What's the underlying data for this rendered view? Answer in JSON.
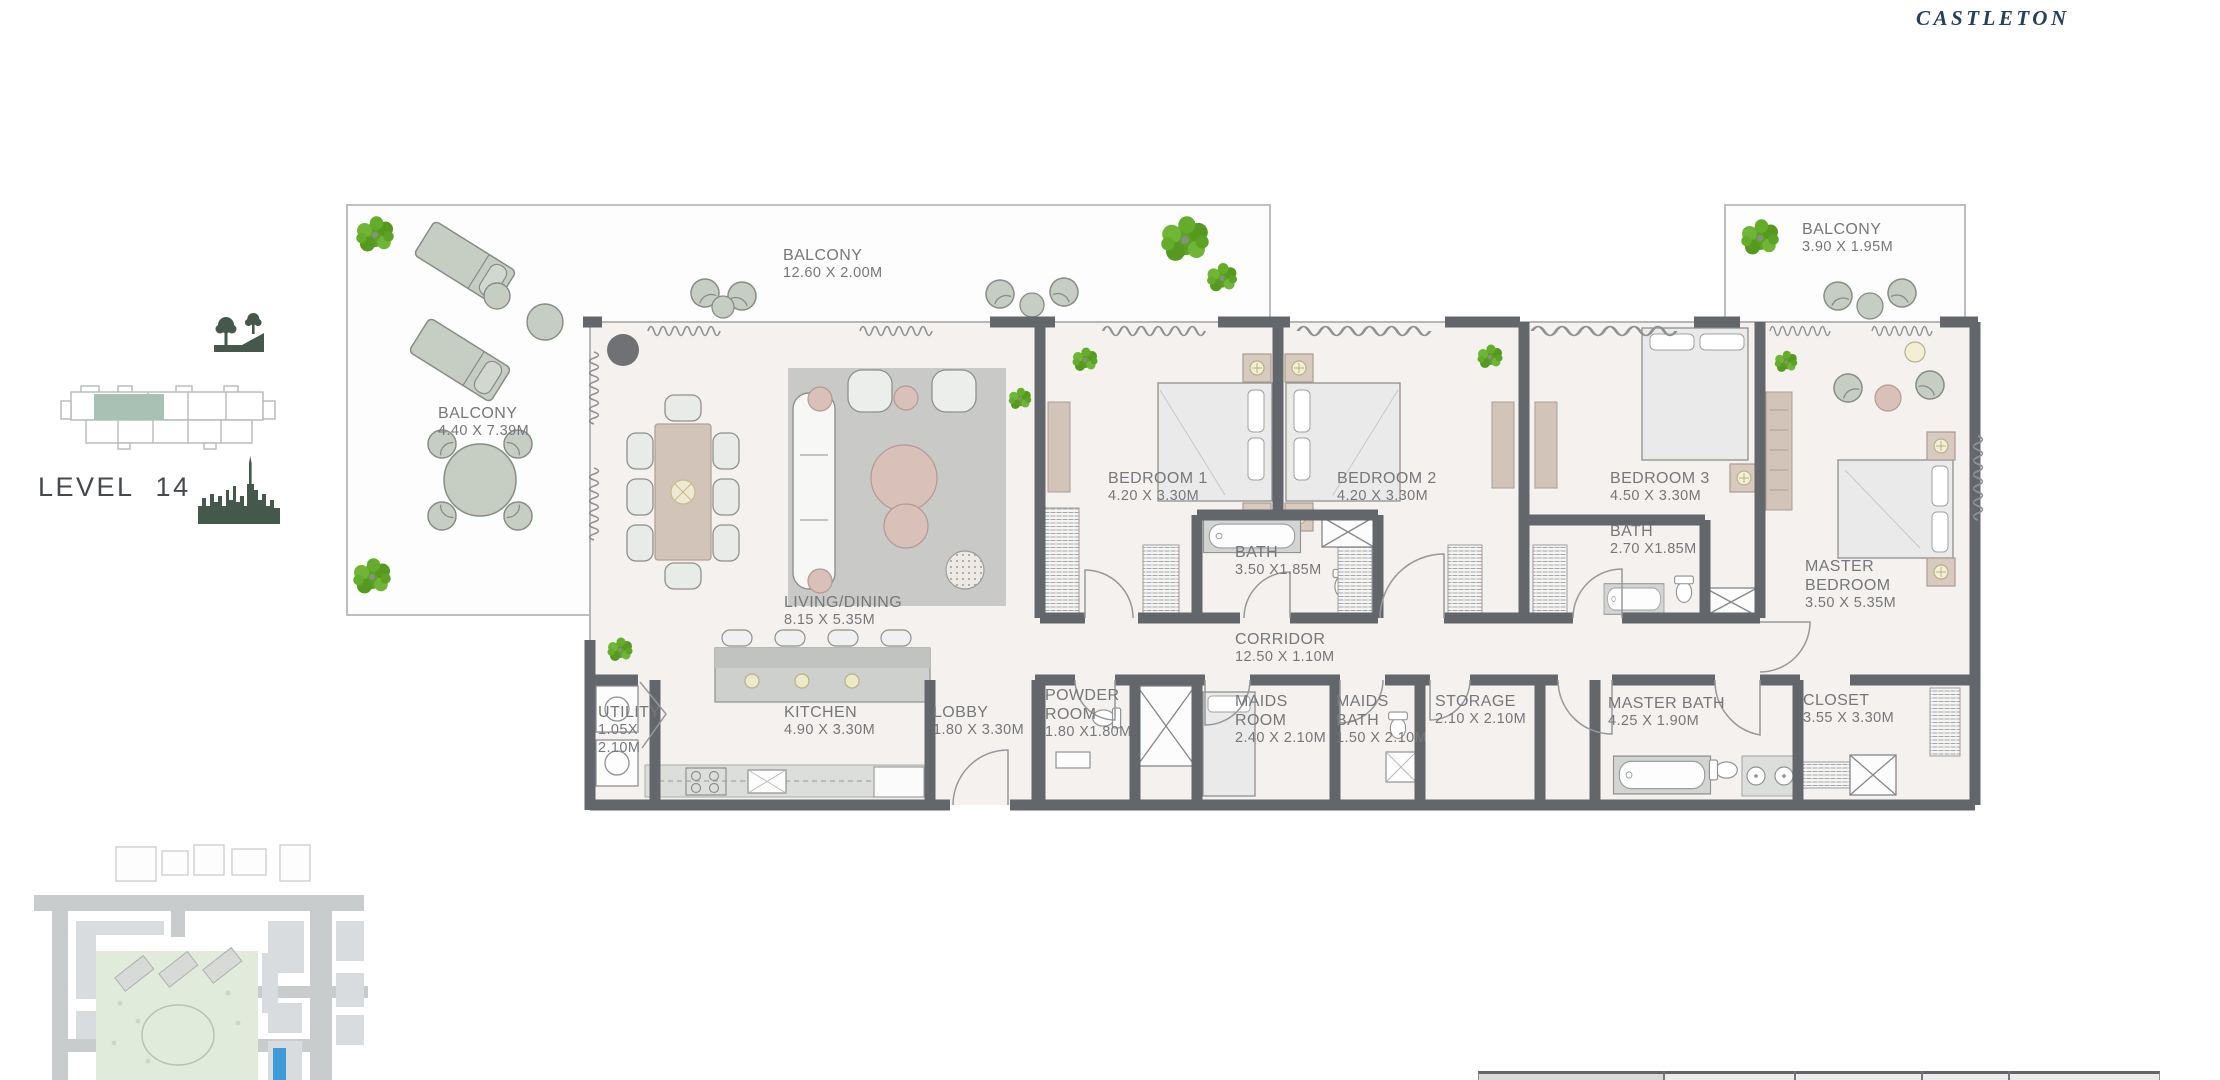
{
  "brand": {
    "logo_text": "CASTLETON"
  },
  "sidebar": {
    "level_label": "LEVEL 14"
  },
  "floor_plan": {
    "rooms": {
      "balcony_left": {
        "name": "BALCONY",
        "dims": "4.40 X 7.39M"
      },
      "balcony_top": {
        "name": "BALCONY",
        "dims": "12.60 X 2.00M"
      },
      "balcony_right": {
        "name": "BALCONY",
        "dims": "3.90 X 1.95M"
      },
      "living_dining": {
        "name": "LIVING/DINING",
        "dims": "8.15 X 5.35M"
      },
      "kitchen": {
        "name": "KITCHEN",
        "dims": "4.90 X 3.30M"
      },
      "lobby": {
        "name": "LOBBY",
        "dims": "1.80 X 3.30M"
      },
      "utility": {
        "name": "UTILITY",
        "dims": "1.05X 2.10M"
      },
      "corridor": {
        "name": "CORRIDOR",
        "dims": "12.50 X 1.10M"
      },
      "bedroom1": {
        "name": "BEDROOM 1",
        "dims": "4.20 X 3.30M"
      },
      "bedroom2": {
        "name": "BEDROOM 2",
        "dims": "4.20 X 3.30M"
      },
      "bedroom3": {
        "name": "BEDROOM 3",
        "dims": "4.50 X 3.30M"
      },
      "bath1": {
        "name": "BATH",
        "dims": "3.50 X1.85M"
      },
      "bath2": {
        "name": "BATH",
        "dims": "2.70 X1.85M"
      },
      "master_bedroom": {
        "name": "MASTER BEDROOM",
        "dims": "3.50 X 5.35M"
      },
      "powder_room": {
        "name": "POWDER ROOM",
        "dims": "1.80 X1.80M"
      },
      "maids_room": {
        "name": "MAIDS ROOM",
        "dims": "2.40 X 2.10M"
      },
      "maids_bath": {
        "name": "MAIDS BATH",
        "dims": "1.50 X 2.10M"
      },
      "storage": {
        "name": "STORAGE",
        "dims": "2.10 X 2.10M"
      },
      "master_bath": {
        "name": "MASTER BATH",
        "dims": "4.25 X 1.90M"
      },
      "closet": {
        "name": "CLOSET",
        "dims": "3.55 X 3.30M"
      }
    }
  },
  "colors": {
    "brand_navy": "#24405a",
    "wall_dark": "#63666b",
    "floor_fill": "#f4f1ef",
    "label_text": "#76777a",
    "tree_green": "#5ca226",
    "icon_green": "#44584c",
    "keyplan_highlight": "#a9c0b4",
    "sitemap_park": "#e0ebdb",
    "sitemap_road": "#c9cccd",
    "sitemap_highlight_blue": "#3e9bd8"
  }
}
